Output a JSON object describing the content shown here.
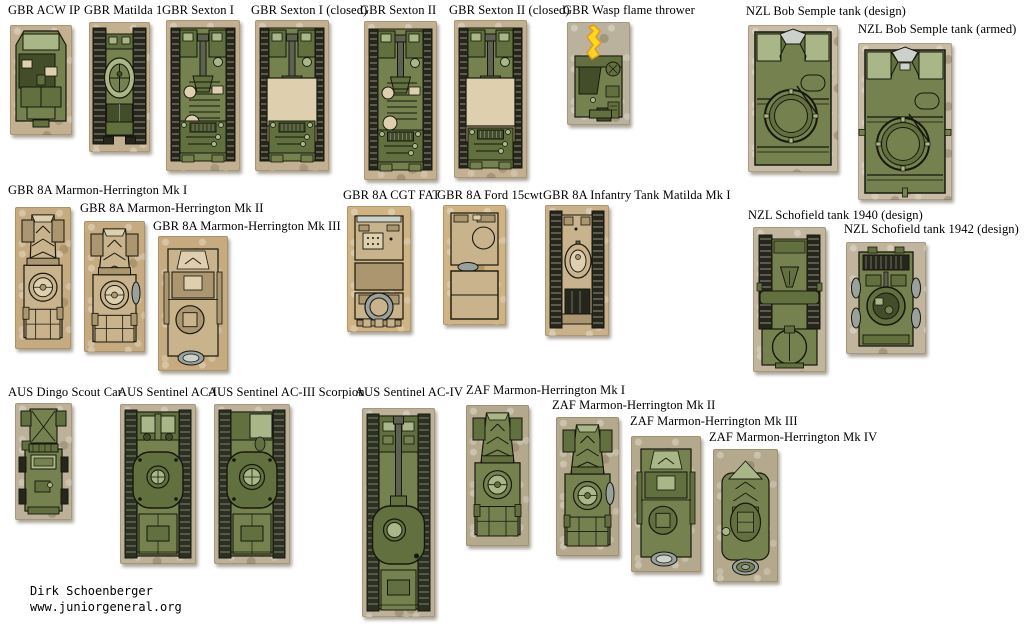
{
  "palette": {
    "ink": "#17170e",
    "green_main": "#75824f",
    "green_light": "#a9b788",
    "green_pale": "#c6cfa8",
    "green_mid": "#62703f",
    "green_dark": "#434d29",
    "track_dark": "#26261c",
    "track_light": "#8e8e82",
    "tan_main": "#c9b38c",
    "tan_light": "#ded0af",
    "tan_mid": "#ab9670",
    "tan_dark": "#7e6d51",
    "gray": "#9aa09c",
    "gray_light": "#ccd1cb",
    "barrel": "#5c6152",
    "flame_yellow": "#ffd820",
    "flame_orange": "#e8961c",
    "page_bg": "#ffffff"
  },
  "credit": {
    "author": "Dirk Schoenberger",
    "website": "www.juniorgeneral.org"
  },
  "vehicles": [
    {
      "id": "gbr-acw-ip",
      "label": "GBR ACW IP",
      "lx": 8,
      "ly": 3,
      "bx": 10,
      "by": 25,
      "bw": 62,
      "bh": 110,
      "kind": "acw",
      "tint": "#c3b091"
    },
    {
      "id": "gbr-matilda-1",
      "label": "GBR Matilda 1",
      "lx": 84,
      "ly": 3,
      "bx": 89,
      "by": 22,
      "bw": 61,
      "bh": 130,
      "kind": "matilda1",
      "tint": "#c3b091"
    },
    {
      "id": "gbr-sexton-i",
      "label": "GBR Sexton I",
      "lx": 162,
      "ly": 3,
      "bx": 166,
      "by": 20,
      "bw": 74,
      "bh": 151,
      "kind": "sexton",
      "variant": "open",
      "tint": "#c3b091"
    },
    {
      "id": "gbr-sexton-i-closed",
      "label": "GBR Sexton I (closed)",
      "lx": 251,
      "ly": 3,
      "bx": 255,
      "by": 20,
      "bw": 74,
      "bh": 151,
      "kind": "sexton",
      "variant": "closed",
      "tint": "#c3b091"
    },
    {
      "id": "gbr-sexton-ii",
      "label": "GBR Sexton II",
      "lx": 360,
      "ly": 3,
      "bx": 364,
      "by": 21,
      "bw": 73,
      "bh": 159,
      "kind": "sexton",
      "variant": "open",
      "tint": "#c3b091"
    },
    {
      "id": "gbr-sexton-ii-closed",
      "label": "GBR Sexton II (closed)",
      "lx": 449,
      "ly": 3,
      "bx": 454,
      "by": 20,
      "bw": 73,
      "bh": 158,
      "kind": "sexton",
      "variant": "closed",
      "tint": "#c3b091"
    },
    {
      "id": "gbr-wasp",
      "label": "GBR Wasp flame thrower",
      "lx": 563,
      "ly": 3,
      "bx": 567,
      "by": 22,
      "bw": 63,
      "bh": 103,
      "kind": "wasp",
      "tint": "#bab29c"
    },
    {
      "id": "nzl-bob-semple-design",
      "label": "NZL Bob Semple tank (design)",
      "lx": 746,
      "ly": 4,
      "bx": 748,
      "by": 25,
      "bw": 90,
      "bh": 147,
      "kind": "bobsemple",
      "variant": "design",
      "tint": "#c8bca6"
    },
    {
      "id": "nzl-bob-semple-armed",
      "label": "NZL Bob Semple tank (armed)",
      "lx": 858,
      "ly": 22,
      "bx": 858,
      "by": 43,
      "bw": 94,
      "bh": 157,
      "kind": "bobsemple",
      "variant": "armed",
      "tint": "#c8bca6"
    },
    {
      "id": "gbr-mh-mk1",
      "label": "GBR 8A Marmon-Herrington Mk I",
      "lx": 8,
      "ly": 183,
      "bx": 15,
      "by": 207,
      "bw": 56,
      "bh": 142,
      "kind": "mh",
      "variant": "mk1",
      "pal": "tan",
      "tint": "#c6ab80"
    },
    {
      "id": "gbr-mh-mk2",
      "label": "GBR 8A Marmon-Herrington Mk II",
      "lx": 80,
      "ly": 201,
      "bx": 84,
      "by": 221,
      "bw": 61,
      "bh": 131,
      "kind": "mh",
      "variant": "mk2",
      "pal": "tan",
      "tint": "#c6ab80"
    },
    {
      "id": "gbr-mh-mk3",
      "label": "GBR 8A Marmon-Herrington Mk III",
      "lx": 153,
      "ly": 219,
      "bx": 158,
      "by": 236,
      "bw": 70,
      "bh": 135,
      "kind": "mh",
      "variant": "mk3",
      "pal": "tan",
      "tint": "#c6ab80"
    },
    {
      "id": "gbr-cgt-fat",
      "label": "GBR 8A CGT FAT",
      "lx": 343,
      "ly": 188,
      "bx": 347,
      "by": 206,
      "bw": 64,
      "bh": 126,
      "kind": "truckfat",
      "tint": "#cfb383"
    },
    {
      "id": "gbr-ford-15cwt",
      "label": "GBR 8A Ford 15cwt",
      "lx": 437,
      "ly": 188,
      "bx": 443,
      "by": 205,
      "bw": 63,
      "bh": 120,
      "kind": "truck15",
      "tint": "#cfb383"
    },
    {
      "id": "gbr-matilda-mki",
      "label": "GBR 8A Infantry Tank Matilda Mk I",
      "lx": 543,
      "ly": 188,
      "bx": 545,
      "by": 205,
      "bw": 64,
      "bh": 131,
      "kind": "matildatan",
      "tint": "#c9b28a"
    },
    {
      "id": "nzl-schofield-1940",
      "label": "NZL Schofield tank 1940 (design)",
      "lx": 748,
      "ly": 208,
      "bx": 753,
      "by": 227,
      "bw": 73,
      "bh": 145,
      "kind": "schofield40",
      "tint": "#c2b59d"
    },
    {
      "id": "nzl-schofield-1942",
      "label": "NZL Schofield tank 1942 (design)",
      "lx": 844,
      "ly": 222,
      "bx": 846,
      "by": 242,
      "bw": 80,
      "bh": 112,
      "kind": "schofield42",
      "tint": "#c2b59d"
    },
    {
      "id": "aus-dingo",
      "label": "AUS Dingo Scout Car",
      "lx": 8,
      "ly": 385,
      "bx": 15,
      "by": 403,
      "bw": 57,
      "bh": 117,
      "kind": "dingo",
      "tint": "#bdb299"
    },
    {
      "id": "aus-sentinel-ac1",
      "label": "AUS Sentinel AC-I",
      "lx": 118,
      "ly": 385,
      "bx": 120,
      "by": 404,
      "bw": 76,
      "bh": 160,
      "kind": "sentinel",
      "variant": "ac1",
      "tint": "#bdb299"
    },
    {
      "id": "aus-sentinel-ac3",
      "label": "AUS Sentinel AC-III Scorpion",
      "lx": 208,
      "ly": 385,
      "bx": 214,
      "by": 404,
      "bw": 76,
      "bh": 160,
      "kind": "sentinel",
      "variant": "ac3",
      "tint": "#bdb299"
    },
    {
      "id": "aus-sentinel-ac4",
      "label": "AUS Sentinel AC-IV",
      "lx": 355,
      "ly": 385,
      "bx": 362,
      "by": 408,
      "bw": 73,
      "bh": 209,
      "kind": "sentinelac4",
      "tint": "#bdb299"
    },
    {
      "id": "zaf-mh-mk1",
      "label": "ZAF Marmon-Herrington Mk I",
      "lx": 466,
      "ly": 383,
      "bx": 466,
      "by": 405,
      "bw": 63,
      "bh": 141,
      "kind": "mh",
      "variant": "mk1",
      "pal": "green",
      "tint": "#b5a98d"
    },
    {
      "id": "zaf-mh-mk2",
      "label": "ZAF Marmon-Herrington Mk II",
      "lx": 552,
      "ly": 398,
      "bx": 556,
      "by": 417,
      "bw": 63,
      "bh": 139,
      "kind": "mh",
      "variant": "mk2",
      "pal": "green",
      "tint": "#b5a98d"
    },
    {
      "id": "zaf-mh-mk3",
      "label": "ZAF Marmon-Herrington Mk III",
      "lx": 630,
      "ly": 414,
      "bx": 631,
      "by": 436,
      "bw": 70,
      "bh": 136,
      "kind": "mh",
      "variant": "mk3",
      "pal": "green",
      "tint": "#b5a98d"
    },
    {
      "id": "zaf-mh-mk4",
      "label": "ZAF Marmon-Herrington Mk IV",
      "lx": 709,
      "ly": 430,
      "bx": 713,
      "by": 449,
      "bw": 65,
      "bh": 133,
      "kind": "mh",
      "variant": "mk4",
      "pal": "green",
      "tint": "#b5a98d"
    }
  ]
}
